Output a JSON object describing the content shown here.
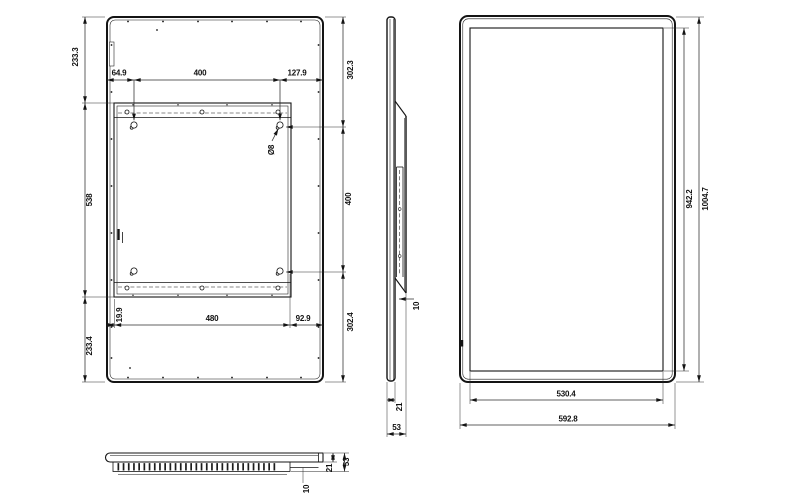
{
  "drawing": {
    "colors": {
      "line": "#141414",
      "dimension_line": "#2b2b2b",
      "background": "#ffffff"
    },
    "dimensions": {
      "back_view": {
        "left": [
          "233.3",
          "538",
          "233.4"
        ],
        "right": [
          "302.3",
          "400",
          "302.4"
        ],
        "top": [
          "64.9",
          "400",
          "127.9"
        ],
        "bottom": [
          "19.9",
          "480",
          "92.9"
        ],
        "hole_diameter": "Ø8"
      },
      "side_view": {
        "bracket_offset": "10",
        "thickness": "21",
        "depth": "53"
      },
      "front_view": {
        "screen_height": "942.2",
        "overall_height": "1004.7",
        "screen_width": "530.4",
        "overall_width": "592.8"
      },
      "bottom_view": {
        "depth": "53",
        "thickness": "21",
        "vent_inset": "10"
      }
    }
  }
}
